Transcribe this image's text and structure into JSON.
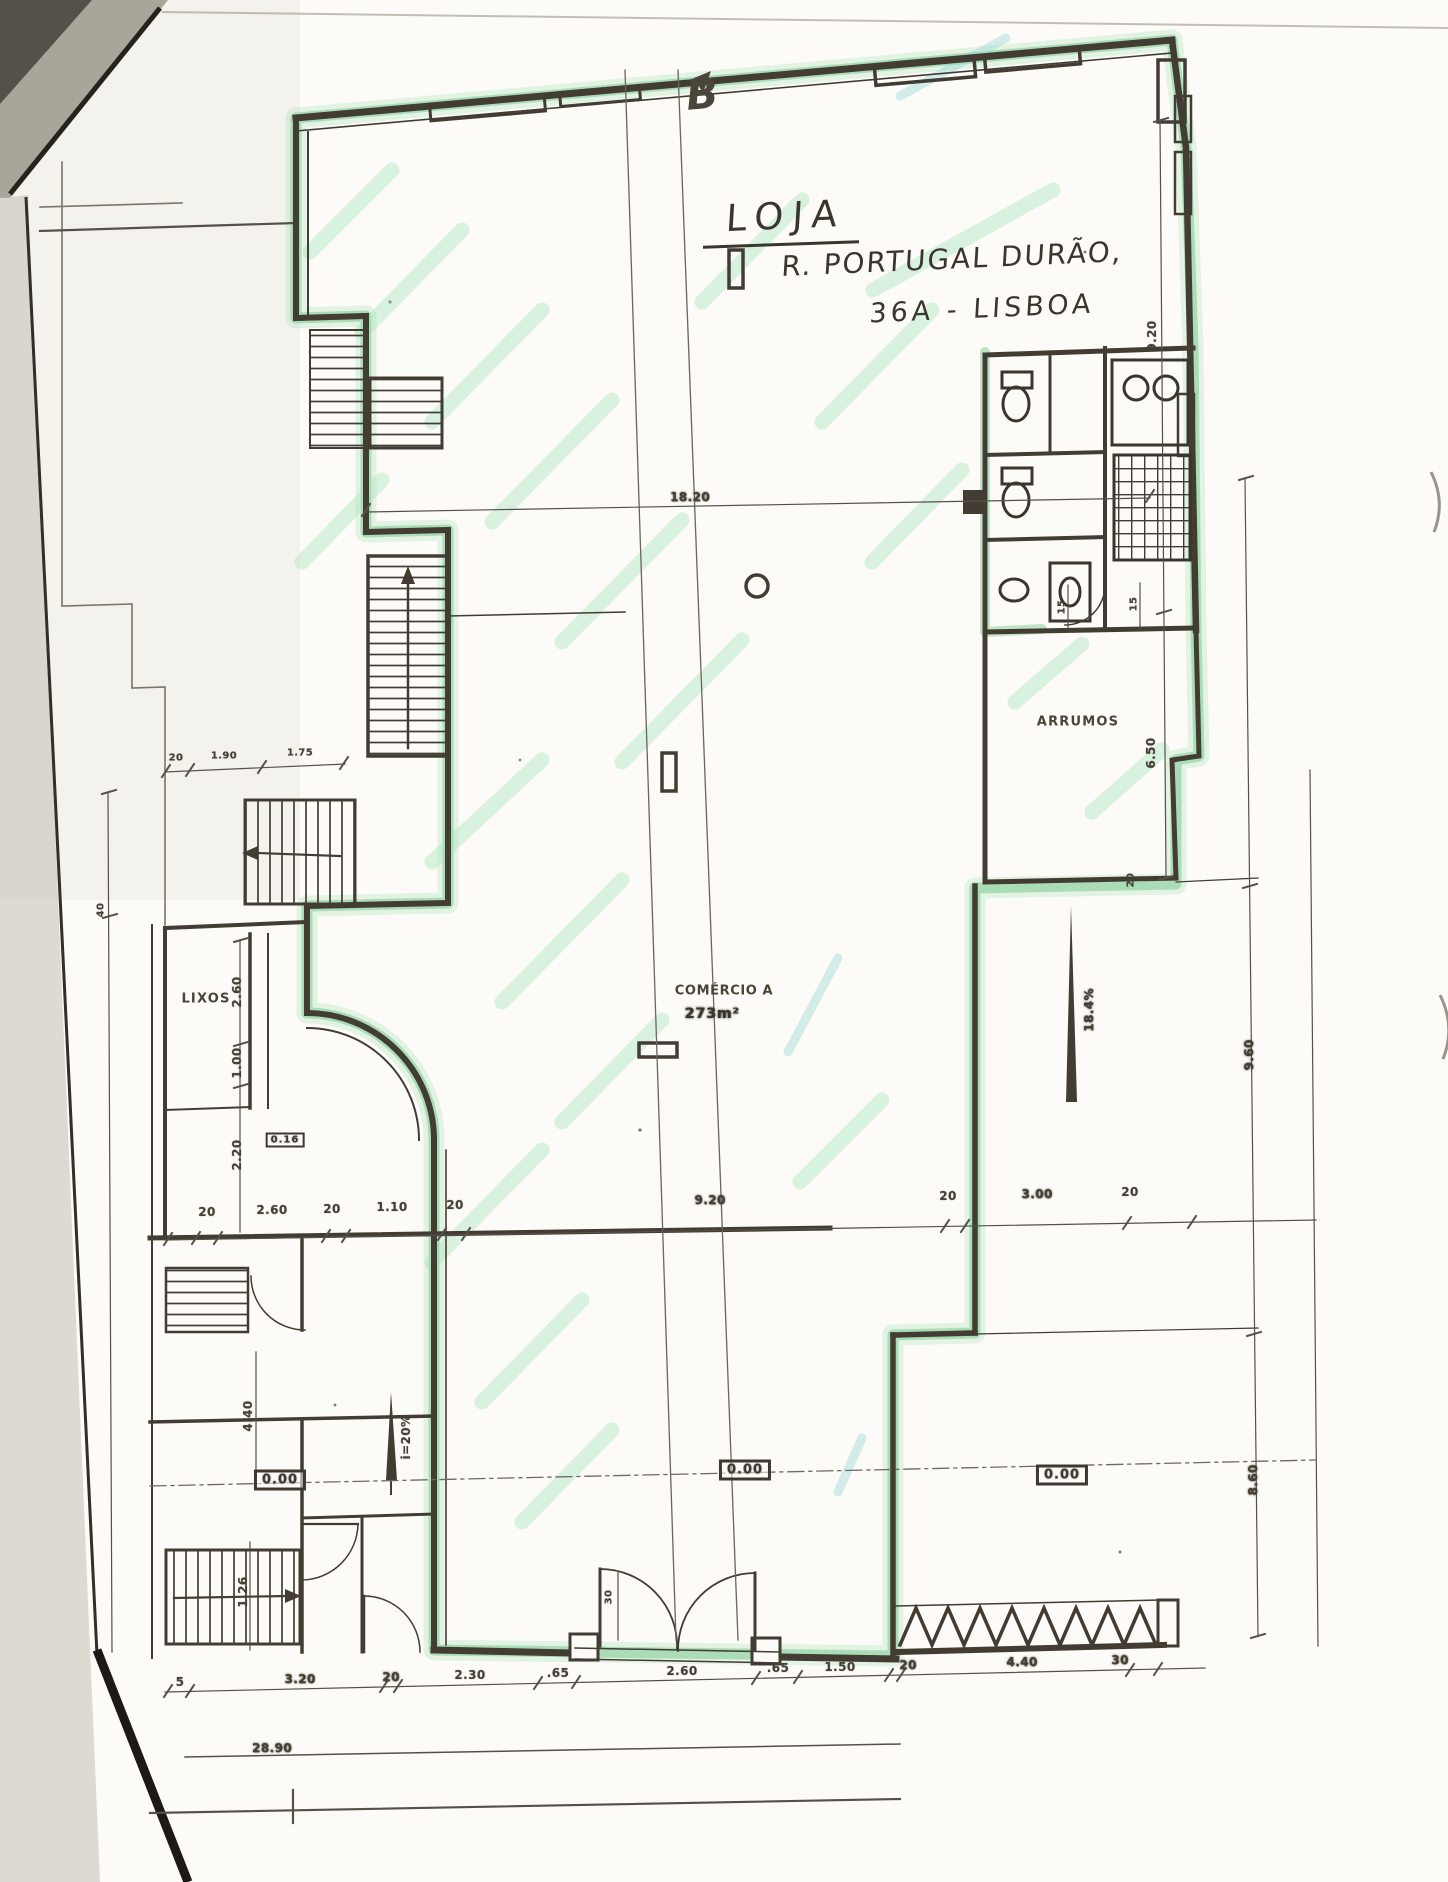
{
  "annotations": {
    "section_marker": "B",
    "title": "LOJA",
    "address_line1": "R. PORTUGAL DURÃO,",
    "address_line2": "36A - LISBOA"
  },
  "rooms": {
    "storage": "ARRUMOS",
    "trash": "LIXOS",
    "commerce_name": "COMÉRCIO A",
    "commerce_area": "273m²"
  },
  "levels": {
    "left_entry": "0.00",
    "center": "0.00",
    "right": "0.00",
    "landing": "0.16"
  },
  "slopes": {
    "left_ramp": "i=20%",
    "right_ramp": "18.4%"
  },
  "dims": {
    "top_total": "18.20",
    "right_upper": "9.20",
    "right_storage": "6.50",
    "margin_upper": "9.60",
    "margin_lower": "8.60",
    "stair1": "20",
    "stair2": "1.90",
    "stair3": "1.75",
    "left_edge": "40",
    "lixos1": "2.60",
    "lixos2": "1.00",
    "lixos3": "2.20",
    "mid1": "20",
    "mid2": "2.60",
    "mid3": "20",
    "mid4": "1.10",
    "mid5": "20",
    "mid6": "9.20",
    "mid7": "20",
    "mid8": "3.00",
    "mid9": "20",
    "bot1": "5",
    "bot2": "3.20",
    "bot3": "20",
    "bot4": "2.30",
    "bot5": ".65",
    "bot6": "2.60",
    "bot7": ".65",
    "bot8": "1.50",
    "bot9": "20",
    "bot10": "4.40",
    "bot11": "30",
    "total_width": "28.90",
    "left_ramp_height": "4.40",
    "left_lower": "1.26",
    "door_side": "30",
    "wc1": "15",
    "wc2": "15",
    "storage_step": "20"
  },
  "colors": {
    "highlighter": "#79c78f",
    "ink": "#423c33"
  }
}
